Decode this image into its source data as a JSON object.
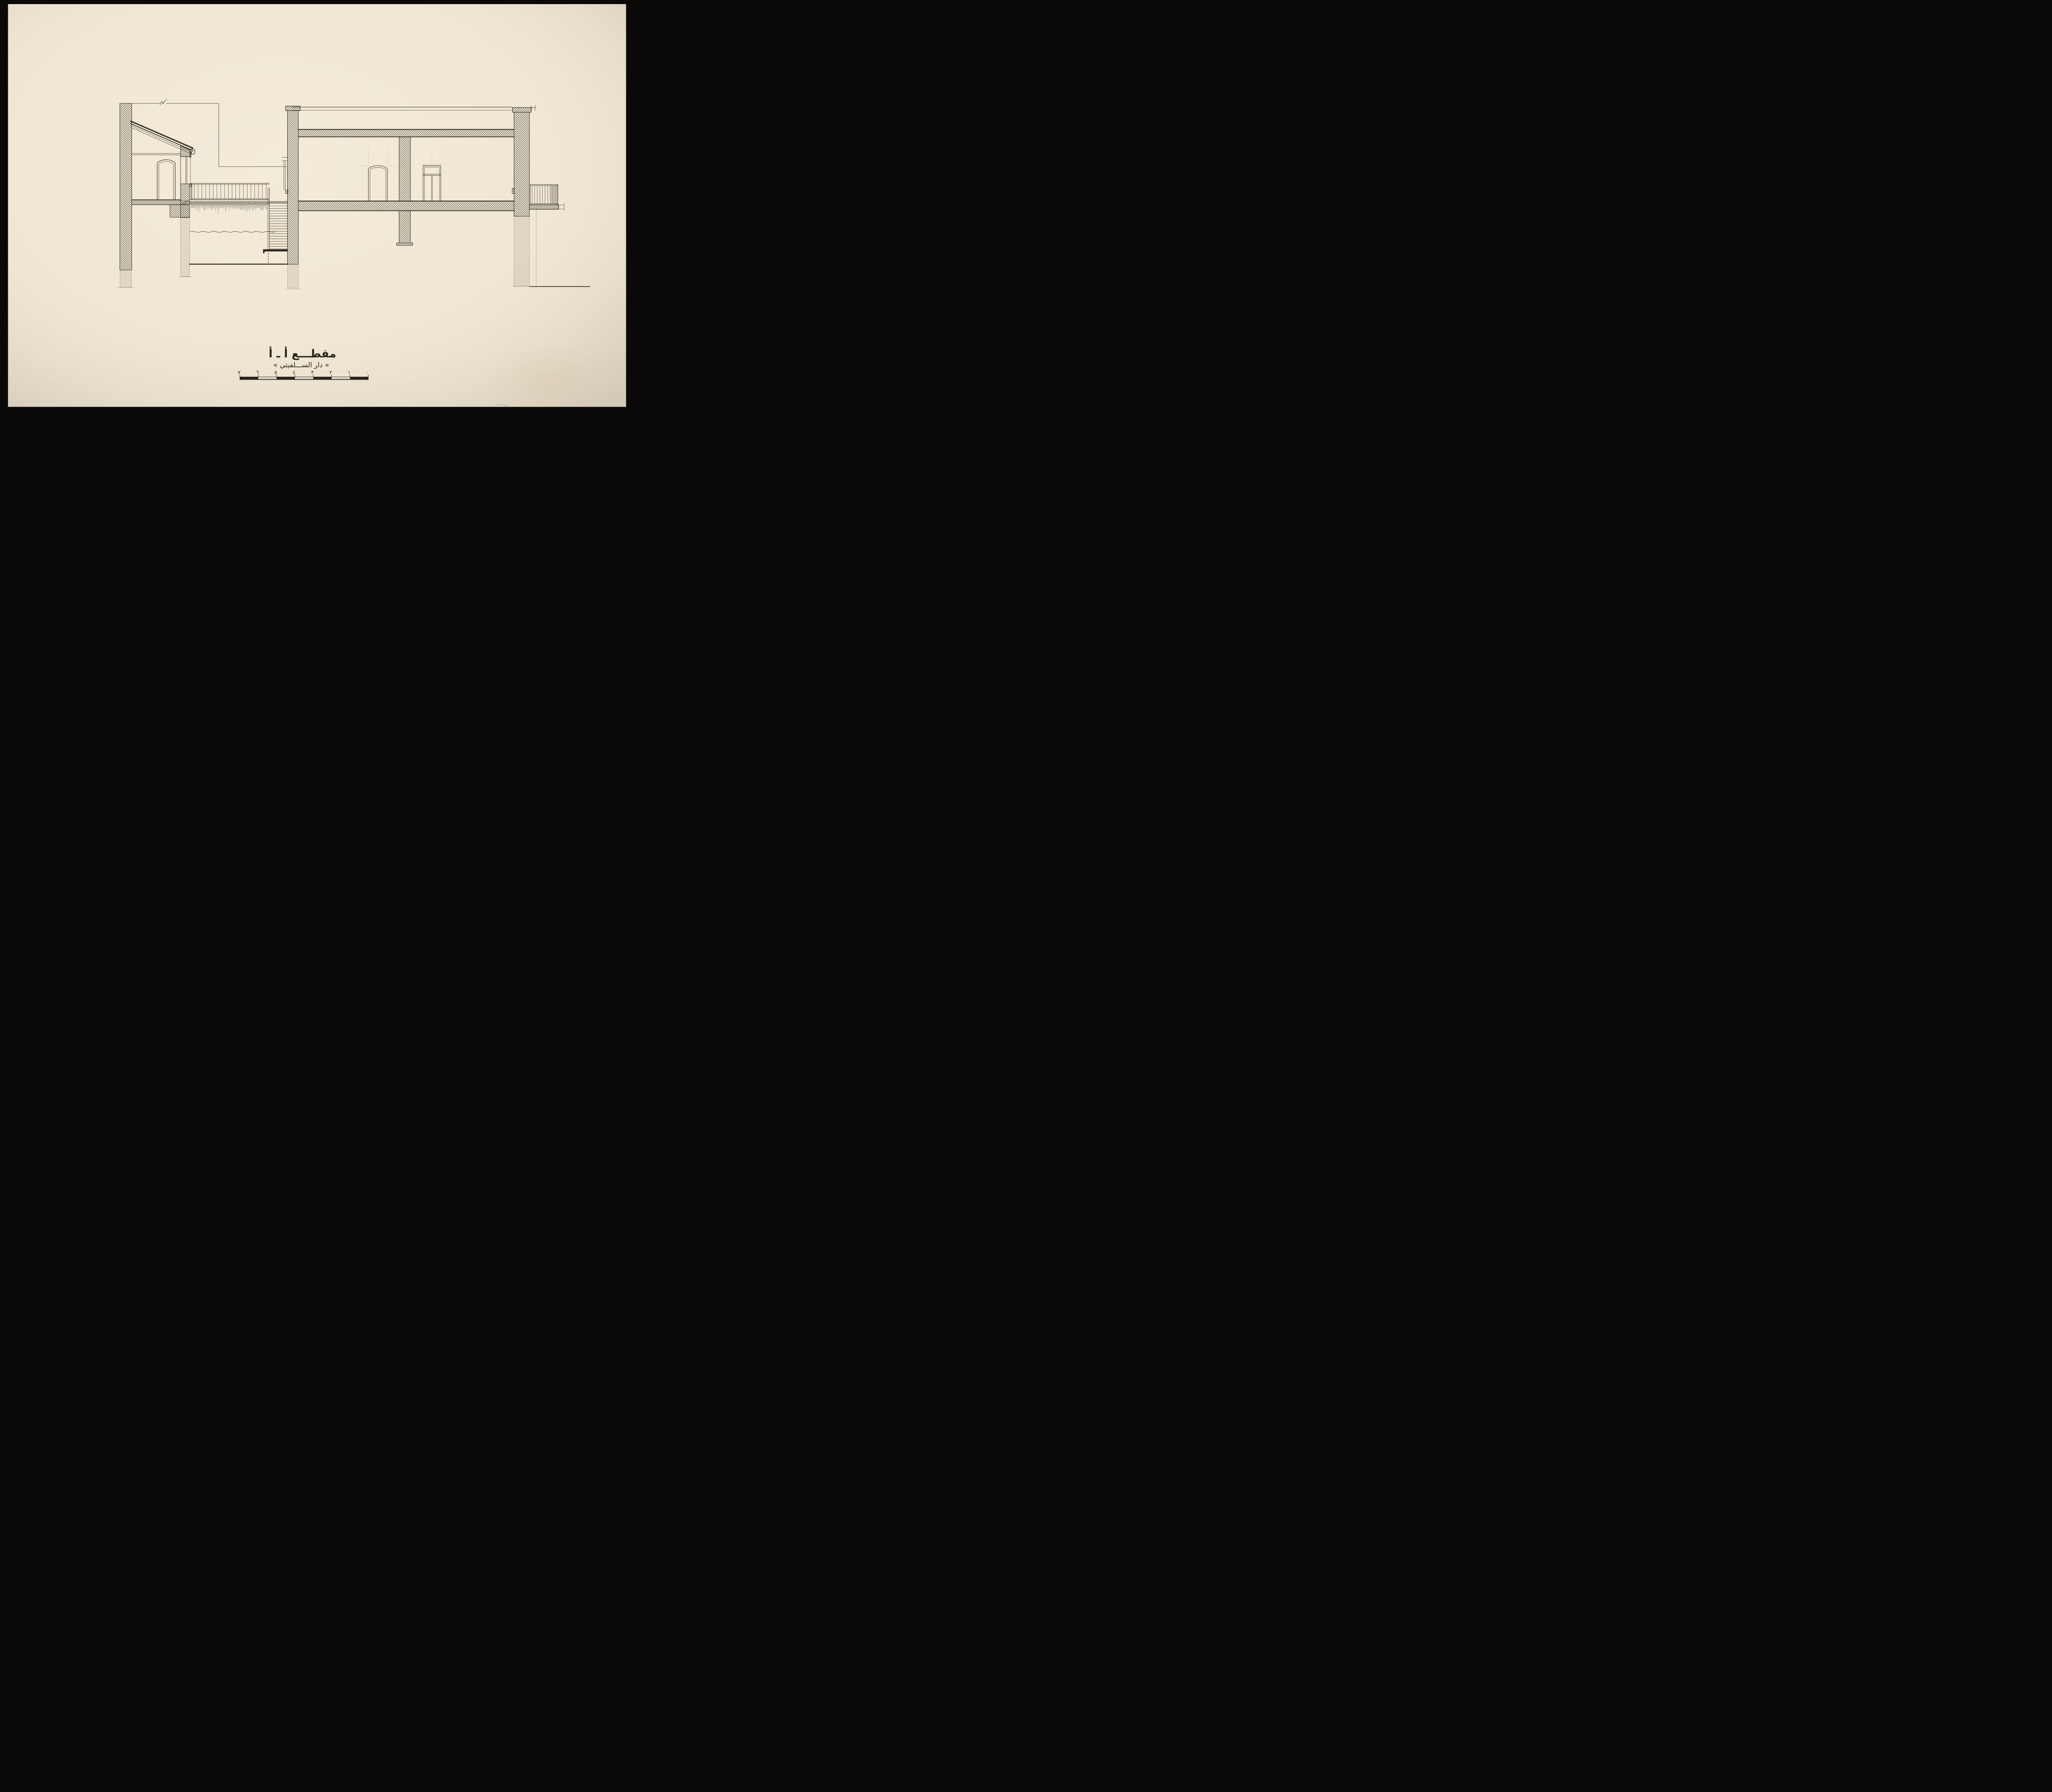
{
  "drawing": {
    "title": "مقطـــع  أ ـ أ",
    "subtitle": "« دار الســـلفيتي »"
  },
  "scale_bar": {
    "labels": [
      "٧",
      "٦",
      "٥",
      "٤",
      "٣",
      "٢",
      "١",
      "٠"
    ],
    "segments": 7
  },
  "colors": {
    "paper": "#efe7d4",
    "paper_light": "#f4edda",
    "ink": "#2b241d",
    "pencil": "#8a7760",
    "border": "#0b0908"
  }
}
